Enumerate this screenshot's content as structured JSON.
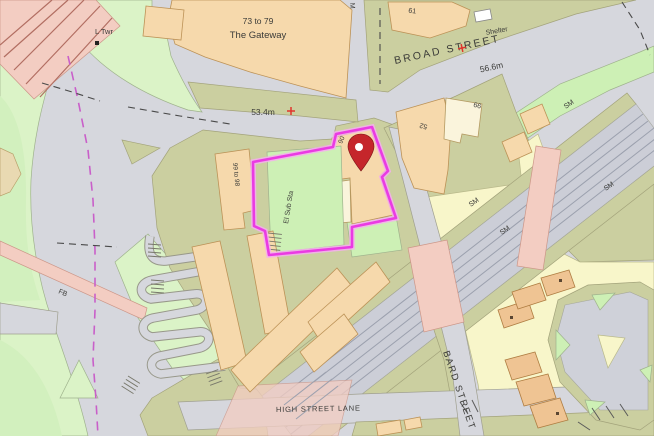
{
  "map_labels": {
    "gateway_line1": "73 to 79",
    "gateway_line2": "The Gateway",
    "l_twr": "L Twr",
    "spot_height_road": "53.4m",
    "broad_street": "BROAD STREET",
    "spot_height_broad": "56.6m",
    "shelter": "Shelter",
    "building_61": "61",
    "top_edge_fragment": "M",
    "building_99_to_98": "99 to 98",
    "el_sub_sta": "El Sub Sta",
    "site_building_90": "90",
    "building_52": "52",
    "building_99": "99",
    "sm": "SM",
    "fb": "FB",
    "bard_street": "BARD STREET",
    "high_street_lane": "HIGH STREET LANE"
  },
  "colors": {
    "site_boundary": "#EA3BE3",
    "location_pin": "#C5262B",
    "road": "#D6D7DD",
    "building_peach": "#F6D9AC",
    "building_orange": "#EFC493",
    "grass_green": "#DBF3C7",
    "verge_khaki": "#CBCFA0",
    "ground_yellow": "#F8F6CA",
    "bridge_pink": "#F3CDC2",
    "railway_gray": "#CCCED7",
    "boundary_dashed_magenta": "#C95FC9",
    "spot_height_cross": "#E0352C"
  }
}
